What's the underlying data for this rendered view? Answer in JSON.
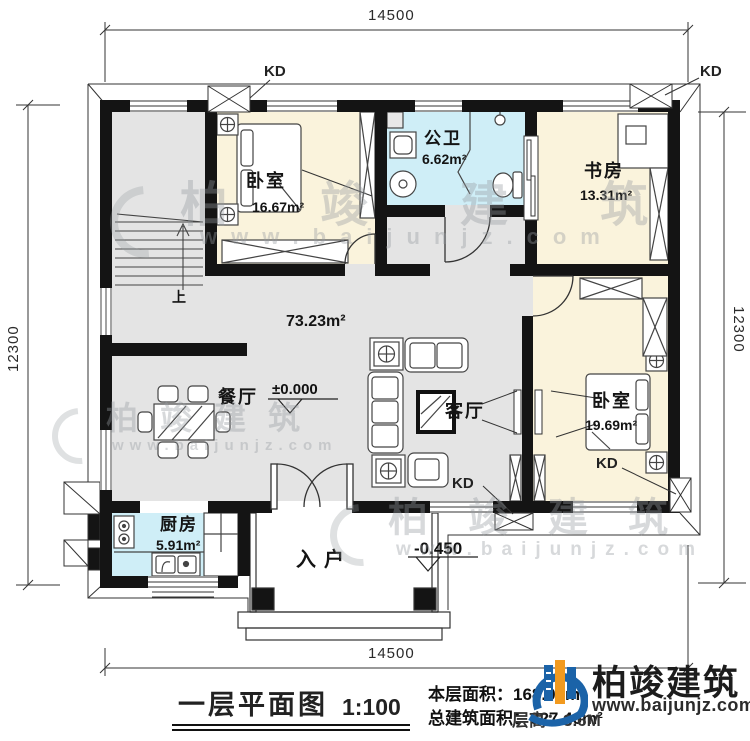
{
  "plan": {
    "dimensions": {
      "top": "14500",
      "bottom": "14500",
      "left": "12300",
      "right": "12300"
    },
    "rooms": {
      "bedroom1": {
        "name": "卧室",
        "area": "16.67m²"
      },
      "bathroom": {
        "name": "公卫",
        "area": "6.62m²"
      },
      "study": {
        "name": "书房",
        "area": "13.31m²"
      },
      "hall": {
        "area": "73.23m²"
      },
      "dining": {
        "name": "餐厅"
      },
      "living": {
        "name": "客厅"
      },
      "bedroom2": {
        "name": "卧室",
        "area": "19.69m²"
      },
      "kitchen": {
        "name": "厨房",
        "area": "5.91m²"
      },
      "entry": {
        "name": "入户"
      }
    },
    "annotations": {
      "kd": "KD",
      "stairs_up": "上",
      "level_main": "±0.000",
      "level_porch": "-0.450"
    }
  },
  "title_block": {
    "title": "一层平面图",
    "scale": "1:100",
    "floor_area_label": "本层面积：",
    "floor_area": "168.08m²",
    "total_area_label": "总建筑面积：",
    "total_area": "327.46m²",
    "storey_height": "层高：3.6M"
  },
  "brand": {
    "name": "柏竣建筑",
    "url": "www.baijunjz.com"
  },
  "watermark": {
    "chars": "柏竣建筑",
    "url": "www.baijunjz.com"
  },
  "colors": {
    "wall": "#141414",
    "floor_gray": "#e4e4e4",
    "room_cream": "#faf3dc",
    "room_blue": "#cfeef7",
    "brand_blue": "#1b63a8",
    "brand_orange": "#f29a1f"
  }
}
